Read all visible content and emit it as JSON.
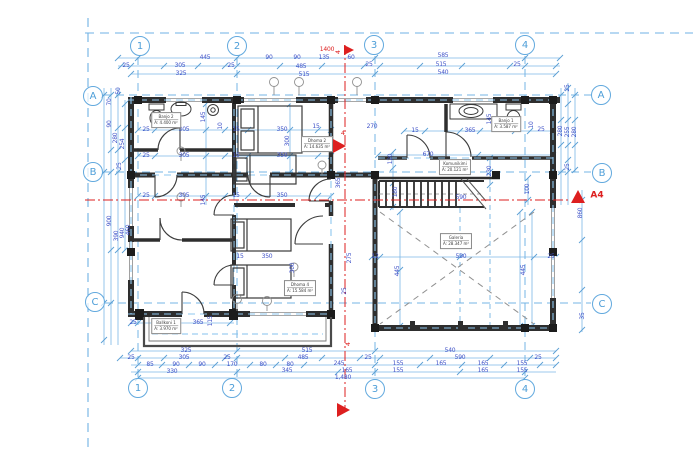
{
  "plan": {
    "title": "first-floor-plan",
    "colors": {
      "dim_text": "#4053c8",
      "dim_line": "#7cb6e6",
      "grid_line": "#6fb2e4",
      "bubble_blue": "#5ba6dc",
      "wall": "#2e2e2e",
      "red": "#dd1f1f"
    },
    "grid_bubbles": [
      {
        "label": "1",
        "x": 140,
        "y": 46
      },
      {
        "label": "2",
        "x": 237,
        "y": 46
      },
      {
        "label": "3",
        "x": 374,
        "y": 45
      },
      {
        "label": "4",
        "x": 525,
        "y": 45
      },
      {
        "label": "1",
        "x": 138,
        "y": 388
      },
      {
        "label": "2",
        "x": 232,
        "y": 388
      },
      {
        "label": "3",
        "x": 375,
        "y": 389
      },
      {
        "label": "4",
        "x": 525,
        "y": 389
      },
      {
        "label": "A",
        "x": 93,
        "y": 96
      },
      {
        "label": "B",
        "x": 93,
        "y": 172
      },
      {
        "label": "C",
        "x": 95,
        "y": 302
      },
      {
        "label": "A",
        "x": 601,
        "y": 95
      },
      {
        "label": "B",
        "x": 602,
        "y": 173
      },
      {
        "label": "C",
        "x": 602,
        "y": 304
      }
    ],
    "dim_labels": [
      {
        "t": "445",
        "x": 205,
        "y": 58
      },
      {
        "t": "90",
        "x": 269,
        "y": 58
      },
      {
        "t": "90",
        "x": 297,
        "y": 58
      },
      {
        "t": "135",
        "x": 324,
        "y": 58
      },
      {
        "t": "60",
        "x": 351,
        "y": 58
      },
      {
        "t": "1400",
        "x": 327,
        "y": 50,
        "c": 1
      },
      {
        "t": "585",
        "x": 443,
        "y": 56
      },
      {
        "t": "25",
        "x": 126,
        "y": 66
      },
      {
        "t": "305",
        "x": 180,
        "y": 66
      },
      {
        "t": "25",
        "x": 231,
        "y": 66
      },
      {
        "t": "485",
        "x": 301,
        "y": 67
      },
      {
        "t": "25",
        "x": 369,
        "y": 65
      },
      {
        "t": "515",
        "x": 441,
        "y": 65
      },
      {
        "t": "25",
        "x": 517,
        "y": 65
      },
      {
        "t": "325",
        "x": 181,
        "y": 74
      },
      {
        "t": "515",
        "x": 304,
        "y": 75
      },
      {
        "t": "540",
        "x": 443,
        "y": 73
      },
      {
        "t": "50",
        "x": 119,
        "y": 91,
        "r": 1
      },
      {
        "t": "70",
        "x": 110,
        "y": 102,
        "r": 1
      },
      {
        "t": "90",
        "x": 110,
        "y": 124,
        "r": 1
      },
      {
        "t": "280",
        "x": 116,
        "y": 138,
        "r": 1
      },
      {
        "t": "254",
        "x": 123,
        "y": 144,
        "r": 1
      },
      {
        "t": "25",
        "x": 120,
        "y": 166,
        "r": 1
      },
      {
        "t": "900",
        "x": 110,
        "y": 221,
        "r": 1
      },
      {
        "t": "390",
        "x": 117,
        "y": 236,
        "r": 1
      },
      {
        "t": "940",
        "x": 123,
        "y": 233,
        "r": 1
      },
      {
        "t": "460",
        "x": 129,
        "y": 230,
        "r": 1
      },
      {
        "t": "25",
        "x": 568,
        "y": 88,
        "r": 1
      },
      {
        "t": "280",
        "x": 561,
        "y": 131,
        "r": 1
      },
      {
        "t": "255",
        "x": 568,
        "y": 132,
        "r": 1
      },
      {
        "t": "280",
        "x": 575,
        "y": 132,
        "r": 1
      },
      {
        "t": "25",
        "x": 568,
        "y": 167,
        "r": 1
      },
      {
        "t": "860",
        "x": 581,
        "y": 213,
        "r": 1
      },
      {
        "t": "35",
        "x": 583,
        "y": 316,
        "r": 1
      },
      {
        "t": "325",
        "x": 186,
        "y": 351
      },
      {
        "t": "515",
        "x": 307,
        "y": 351
      },
      {
        "t": "540",
        "x": 450,
        "y": 351
      },
      {
        "t": "25",
        "x": 131,
        "y": 358
      },
      {
        "t": "305",
        "x": 184,
        "y": 358
      },
      {
        "t": "25",
        "x": 227,
        "y": 358
      },
      {
        "t": "485",
        "x": 303,
        "y": 358
      },
      {
        "t": "25",
        "x": 368,
        "y": 358
      },
      {
        "t": "590",
        "x": 460,
        "y": 358
      },
      {
        "t": "25",
        "x": 538,
        "y": 358
      },
      {
        "t": "85",
        "x": 150,
        "y": 365
      },
      {
        "t": "90",
        "x": 176,
        "y": 365
      },
      {
        "t": "90",
        "x": 202,
        "y": 365
      },
      {
        "t": "170",
        "x": 232,
        "y": 365
      },
      {
        "t": "80",
        "x": 263,
        "y": 365
      },
      {
        "t": "80",
        "x": 290,
        "y": 365
      },
      {
        "t": "245",
        "x": 339,
        "y": 364
      },
      {
        "t": "155",
        "x": 398,
        "y": 364
      },
      {
        "t": "165",
        "x": 441,
        "y": 364
      },
      {
        "t": "165",
        "x": 483,
        "y": 364
      },
      {
        "t": "155",
        "x": 522,
        "y": 364
      },
      {
        "t": "330",
        "x": 172,
        "y": 372
      },
      {
        "t": "345",
        "x": 287,
        "y": 371
      },
      {
        "t": "165",
        "x": 347,
        "y": 371
      },
      {
        "t": "155",
        "x": 398,
        "y": 371
      },
      {
        "t": "165",
        "x": 483,
        "y": 371
      },
      {
        "t": "155",
        "x": 522,
        "y": 371
      },
      {
        "t": "1,480",
        "x": 343,
        "y": 378
      },
      {
        "t": "25",
        "x": 146,
        "y": 130
      },
      {
        "t": "305",
        "x": 184,
        "y": 130
      },
      {
        "t": "15",
        "x": 236,
        "y": 130
      },
      {
        "t": "350",
        "x": 282,
        "y": 130
      },
      {
        "t": "25",
        "x": 146,
        "y": 156
      },
      {
        "t": "305",
        "x": 184,
        "y": 156
      },
      {
        "t": "15",
        "x": 236,
        "y": 156
      },
      {
        "t": "350",
        "x": 282,
        "y": 156
      },
      {
        "t": "25",
        "x": 146,
        "y": 196
      },
      {
        "t": "305",
        "x": 184,
        "y": 196
      },
      {
        "t": "15",
        "x": 236,
        "y": 196
      },
      {
        "t": "350",
        "x": 282,
        "y": 196
      },
      {
        "t": "145",
        "x": 204,
        "y": 117,
        "r": 1
      },
      {
        "t": "10",
        "x": 221,
        "y": 126,
        "r": 1
      },
      {
        "t": "300",
        "x": 288,
        "y": 141,
        "r": 1
      },
      {
        "t": "145",
        "x": 204,
        "y": 200,
        "r": 1
      },
      {
        "t": "270",
        "x": 372,
        "y": 127
      },
      {
        "t": "15",
        "x": 316,
        "y": 127
      },
      {
        "t": "120",
        "x": 391,
        "y": 159,
        "r": 1
      },
      {
        "t": "365",
        "x": 339,
        "y": 183,
        "r": 1
      },
      {
        "t": "670",
        "x": 428,
        "y": 155
      },
      {
        "t": "15",
        "x": 415,
        "y": 131
      },
      {
        "t": "365",
        "x": 470,
        "y": 131
      },
      {
        "t": "145",
        "x": 490,
        "y": 119,
        "r": 1
      },
      {
        "t": "10",
        "x": 532,
        "y": 125,
        "r": 1
      },
      {
        "t": "25",
        "x": 541,
        "y": 130
      },
      {
        "t": "180",
        "x": 396,
        "y": 192,
        "r": 1
      },
      {
        "t": "230",
        "x": 490,
        "y": 171,
        "r": 1
      },
      {
        "t": "100",
        "x": 528,
        "y": 189,
        "r": 1
      },
      {
        "t": "590",
        "x": 461,
        "y": 198
      },
      {
        "t": "12",
        "x": 375,
        "y": 257
      },
      {
        "t": "590",
        "x": 461,
        "y": 257
      },
      {
        "t": "25",
        "x": 551,
        "y": 257
      },
      {
        "t": "445",
        "x": 398,
        "y": 271,
        "r": 1
      },
      {
        "t": "445",
        "x": 524,
        "y": 270,
        "r": 1
      },
      {
        "t": "15",
        "x": 240,
        "y": 257
      },
      {
        "t": "350",
        "x": 267,
        "y": 257
      },
      {
        "t": "300",
        "x": 293,
        "y": 268,
        "r": 1
      },
      {
        "t": "275",
        "x": 350,
        "y": 258,
        "r": 1
      },
      {
        "t": "25",
        "x": 345,
        "y": 291,
        "r": 1
      },
      {
        "t": "365",
        "x": 198,
        "y": 323
      },
      {
        "t": "115",
        "x": 211,
        "y": 321,
        "r": 1
      },
      {
        "t": "25",
        "x": 133,
        "y": 323
      }
    ],
    "room_labels": [
      {
        "name": "Banjo 2",
        "area": "A: 4.400 m²",
        "x": 166,
        "y": 120
      },
      {
        "name": "Dhoma 2",
        "area": "A: 14.635 m²",
        "x": 317,
        "y": 144
      },
      {
        "name": "Banjo 1",
        "area": "A: 3.587 m²",
        "x": 506,
        "y": 124
      },
      {
        "name": "Komunikimi",
        "area": "A: 20.121 m²",
        "x": 455,
        "y": 167
      },
      {
        "name": "Galeria",
        "area": "A: 28.347 m²",
        "x": 456,
        "y": 241
      },
      {
        "name": "Dhoma 4",
        "area": "A: 15.584 m²",
        "x": 300,
        "y": 288
      },
      {
        "name": "Ballkoni 1",
        "area": "A: 3.970 m²",
        "x": 166,
        "y": 326
      }
    ],
    "red_labels": [
      {
        "t": "4",
        "x": 338,
        "y": 52,
        "r": 1
      },
      {
        "t": "4",
        "x": 348,
        "y": 344,
        "r": 1
      },
      {
        "t": "4",
        "x": 343,
        "y": 133
      },
      {
        "t": "A4",
        "x": 597,
        "y": 196,
        "big": 1
      }
    ]
  }
}
